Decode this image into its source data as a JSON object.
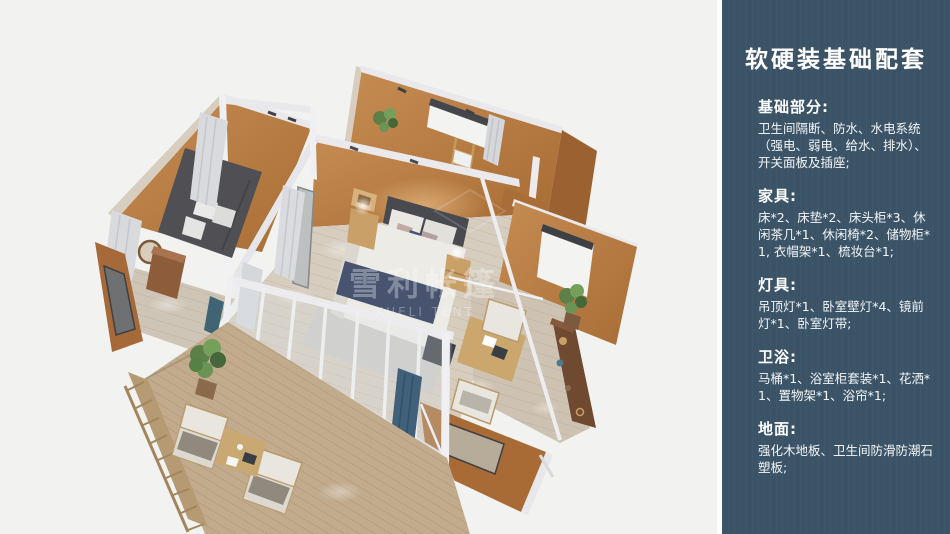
{
  "panel": {
    "title": "软硬装基础配套",
    "bg_color": "#3b5366",
    "text_color": "#ffffff",
    "sections": [
      {
        "heading": "基础部分:",
        "body": "卫生间隔断、防水、水电系统（强电、弱电、给水、排水）、开关面板及插座;"
      },
      {
        "heading": "家具:",
        "body": "床*2、床垫*2、床头柜*3、休闲茶几*1、休闲椅*2、储物柜*1, 衣帽架*1、梳妆台*1;"
      },
      {
        "heading": "灯具:",
        "body": "吊顶灯*1、卧室壁灯*4、镜前灯*1、卧室灯带;"
      },
      {
        "heading": "卫浴:",
        "body": "马桶*1、浴室柜套装*1、花洒*1、置物架*1、浴帘*1;"
      },
      {
        "heading": "地面:",
        "body": "强化木地板、卫生间防滑防潮石塑板;"
      }
    ]
  },
  "illustration": {
    "watermark": "雪利帐篷",
    "watermark_latin": "XUELI TENT",
    "colors": {
      "background": "#f2f2f1",
      "wall_terracotta": "#b5793f",
      "wall_shadow": "#9c6130",
      "frame_white": "#e9e9ec",
      "floor_wood": "#d6cdbf",
      "deck_wood": "#c1ab8c",
      "bedding_white": "#edebe6",
      "bedding_navy": "#47536f",
      "plant_green": "#5d8049",
      "curtain_gray": "#d9dade",
      "curtain_blue": "#406179"
    }
  }
}
